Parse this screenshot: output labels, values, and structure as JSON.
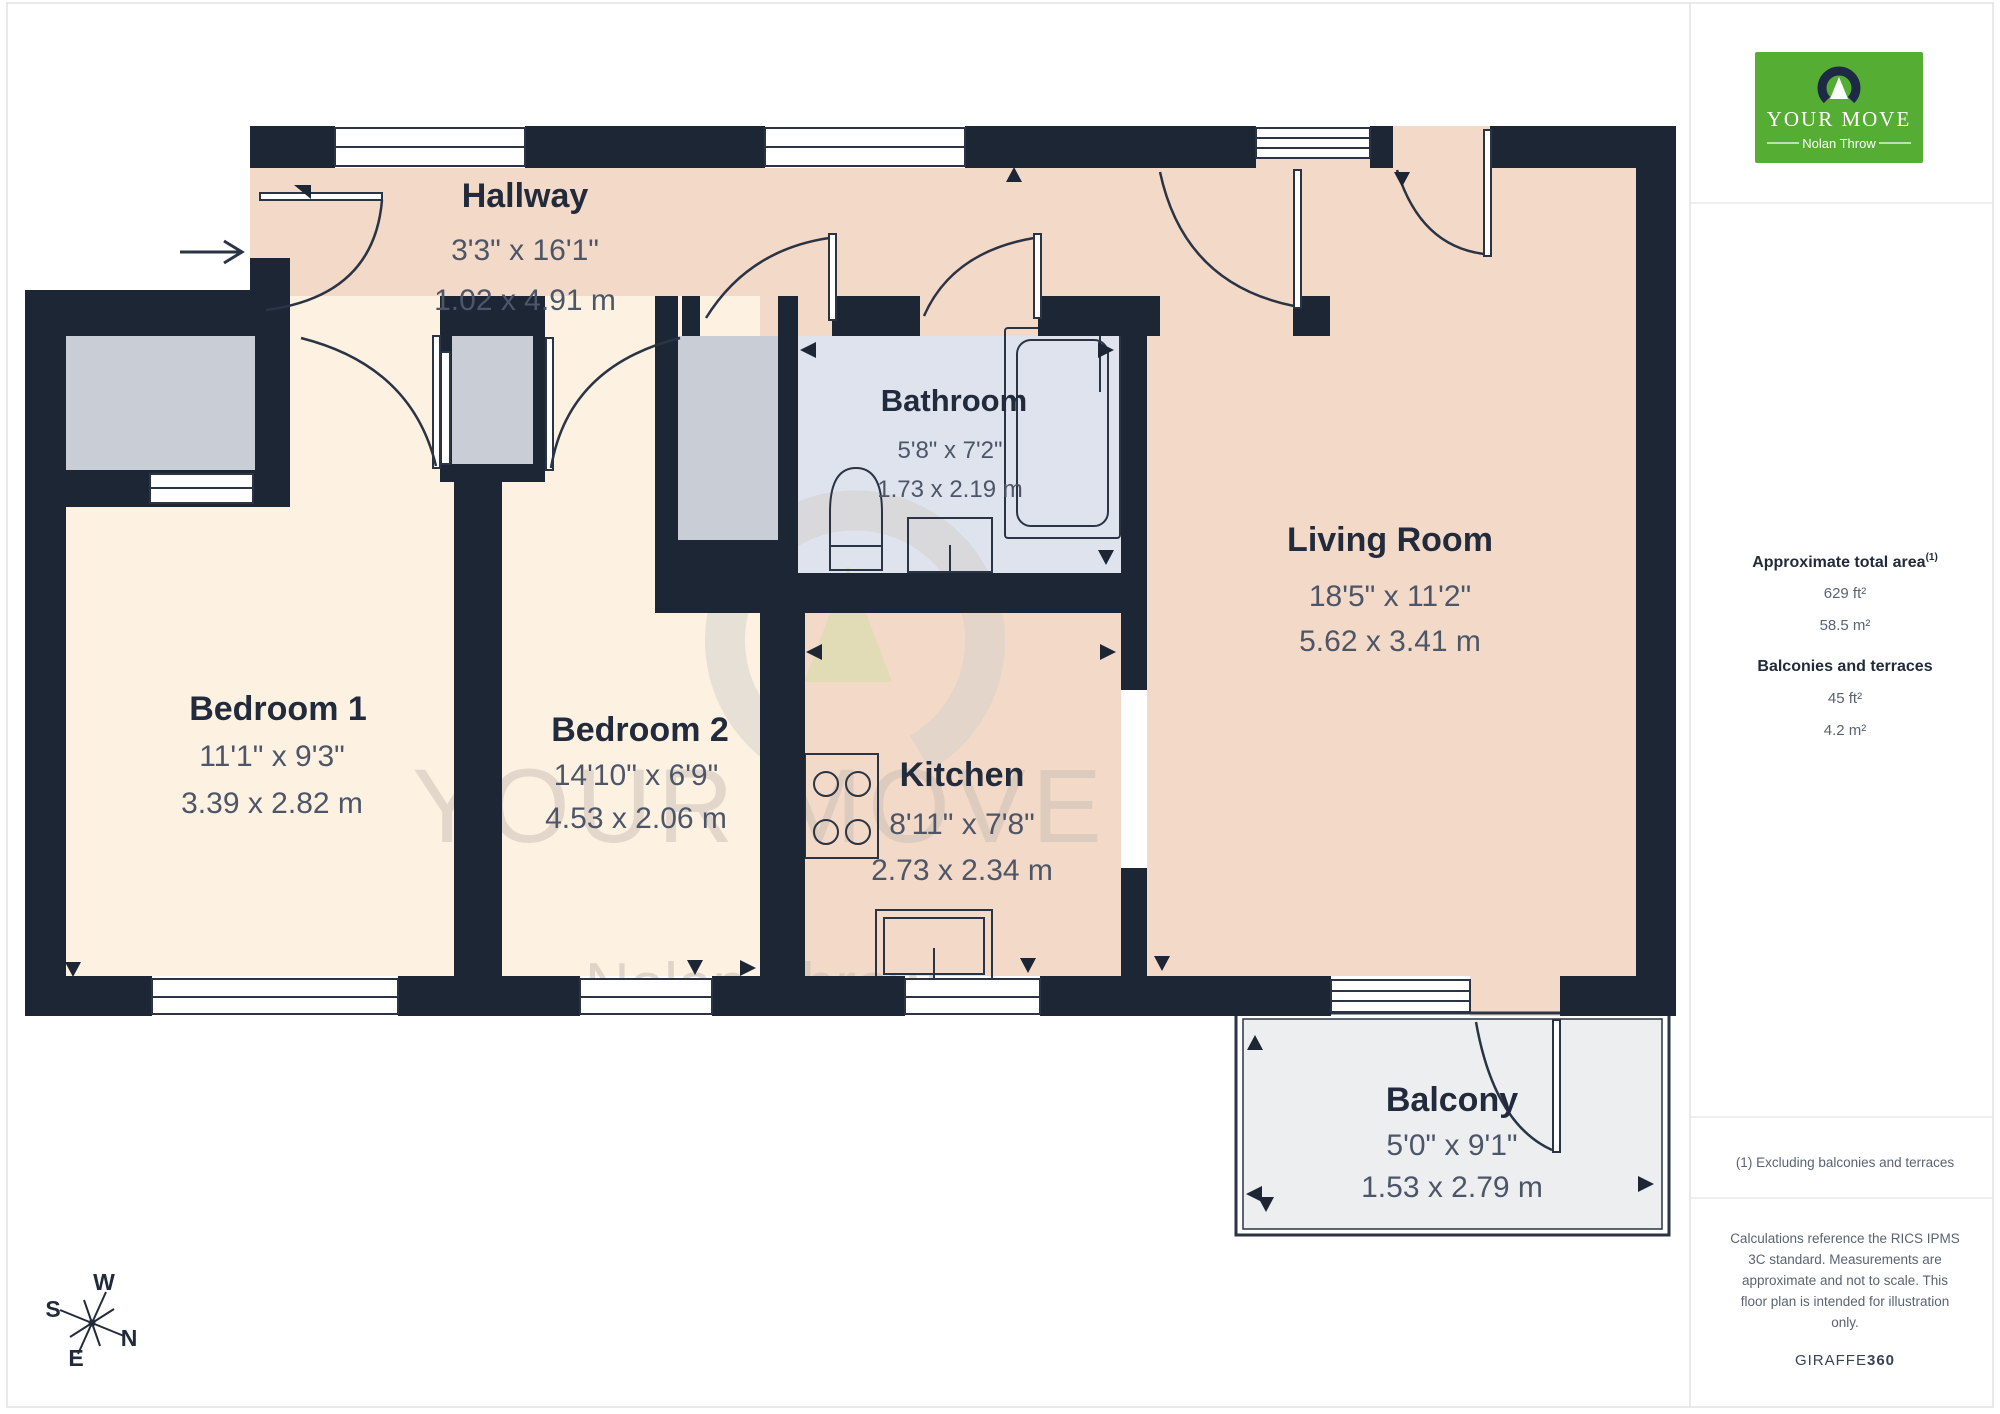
{
  "rooms": {
    "hallway": {
      "name": "Hallway",
      "imperial": "3'3\" x 16'1\"",
      "metric": "1.02 x 4.91 m"
    },
    "bathroom": {
      "name": "Bathroom",
      "imperial": "5'8\" x 7'2\"",
      "metric": "1.73 x 2.19 m"
    },
    "living": {
      "name": "Living Room",
      "imperial": "18'5\" x 11'2\"",
      "metric": "5.62 x 3.41 m"
    },
    "bedroom1": {
      "name": "Bedroom 1",
      "imperial": "11'1\" x 9'3\"",
      "metric": "3.39 x 2.82 m"
    },
    "bedroom2": {
      "name": "Bedroom 2",
      "imperial": "14'10\" x 6'9\"",
      "metric": "4.53 x 2.06 m"
    },
    "kitchen": {
      "name": "Kitchen",
      "imperial": "8'11\" x 7'8\"",
      "metric": "2.73 x 2.34 m"
    },
    "balcony": {
      "name": "Balcony",
      "imperial": "5'0\" x 9'1\"",
      "metric": "1.53 x 2.79 m"
    }
  },
  "sidebar": {
    "logo": {
      "brand": "YOUR MOVE",
      "sub": "Nolan Throw"
    },
    "total_area": {
      "label": "Approximate total area",
      "sup": "(1)",
      "ft": "629 ft²",
      "m": "58.5 m²"
    },
    "balconies": {
      "label": "Balconies and terraces",
      "ft": "45 ft²",
      "m": "4.2 m²"
    },
    "footnote": "(1) Excluding balconies and terraces",
    "disclaimer": {
      "line1": "Calculations reference the RICS IPMS",
      "line2": "3C standard. Measurements are",
      "line3": "approximate and not to scale. This",
      "line4": "floor plan is intended for illustration",
      "line5": "only."
    },
    "credit": {
      "name": "GIRAFFE",
      "suffix": "360"
    }
  },
  "watermark": {
    "brand": "YOUR MOVE",
    "sub": "Nolan Throw"
  },
  "compass": {
    "n": "N",
    "s": "S",
    "e": "E",
    "w": "W"
  },
  "colors": {
    "wall": "#1d2634",
    "hallway_living_kitchen": "#f3d9c7",
    "bedroom": "#fdf1e2",
    "bathroom": "#dee3ee",
    "closet": "#c9ced6",
    "balcony": "#eceef0",
    "brand_green": "#55ae33",
    "brand_navy": "#1e2a45"
  }
}
